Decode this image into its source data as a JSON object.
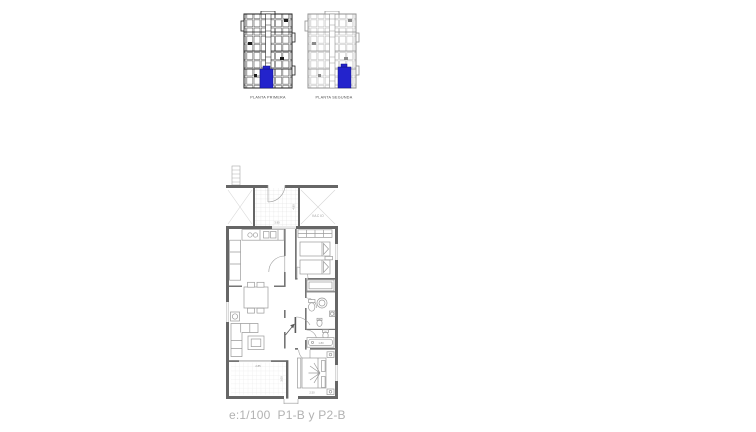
{
  "key_plans": {
    "highlight_color": "#2323cc",
    "items": [
      {
        "label": "PLANTA PRIMERA"
      },
      {
        "label": "PLANTA SEGUNDA"
      }
    ]
  },
  "floor_plan": {
    "void_label": "VACIO",
    "dims": {
      "terrace_top_width": "3.90",
      "terrace_top_depth": "4.80",
      "bathtub": "1.80",
      "master_bed_width": "2.50",
      "terrace_bottom_width": "2.85",
      "terrace_bottom_depth": "3.00"
    }
  },
  "caption": {
    "text": "e:1/100  P1-B y P2-B"
  }
}
